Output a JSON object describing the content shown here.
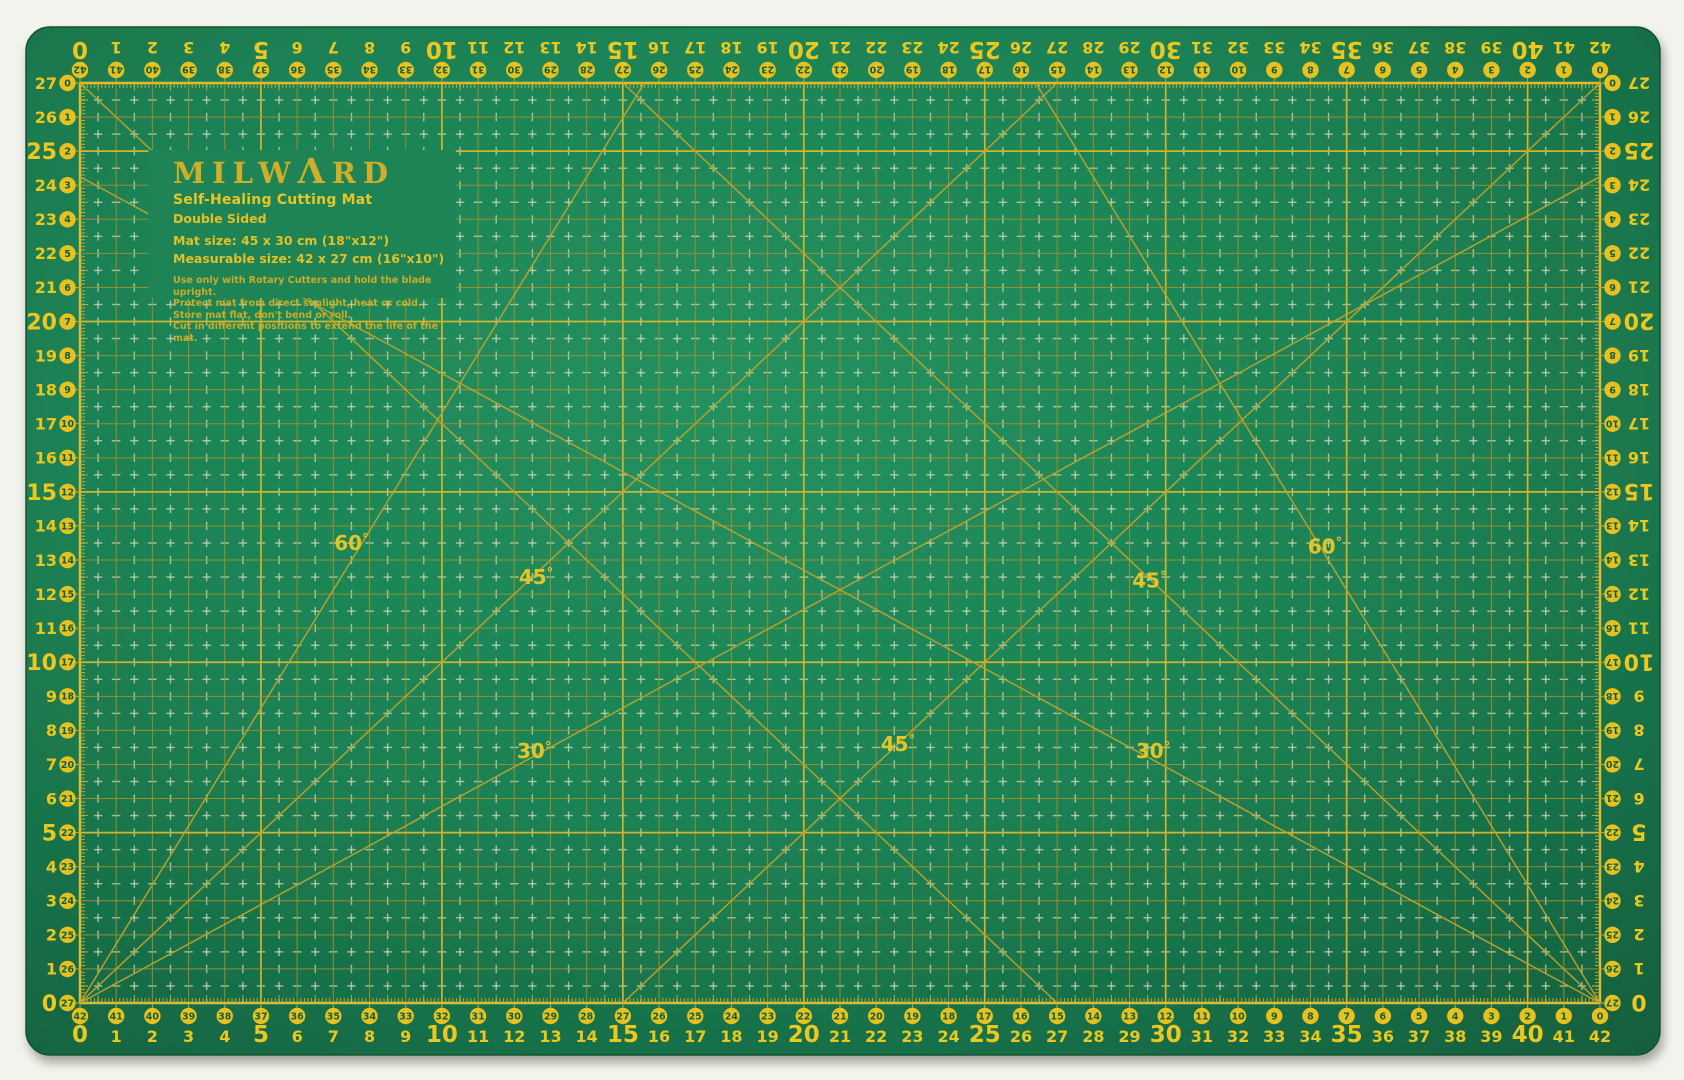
{
  "photo": {
    "backdrop_color": "#f3f3ee"
  },
  "mat": {
    "base_color": "#1d8154",
    "vignette_inner": "#229160",
    "vignette_outer": "#135e3d",
    "minor_line_color": "#a3902f",
    "major_line_color": "#d2b430",
    "boundary_line_color": "#ddbe36",
    "tick_color": "#cbad2e",
    "diagonal_color": "#bda32d",
    "cross_color": "#d6dbb0",
    "number_color": "#ecc71f",
    "circle_fill": "#e7c120",
    "circle_text_color": "#14603e",
    "angle_label_color": "#e6c427",
    "measurable_cm": {
      "width": 42,
      "height": 27
    }
  },
  "label_block": {
    "brand": "MILWARD",
    "brand_display": "MILWΛRD",
    "title": "Self-Healing Cutting Mat",
    "subtitle": "Double Sided",
    "mat_size": "Mat size: 45 x 30 cm (18\"x12\")",
    "measurable_size": "Measurable size: 42 x 27 cm (16\"x10\")",
    "notes": [
      "Use only with Rotary Cutters and hold the blade upright.",
      "Protect mat from direct sunlight, heat or cold.",
      "Store mat flat, don't bend or roll.",
      "Cut in different positions to extend the life of the mat."
    ]
  },
  "rulers": {
    "horizontal": {
      "numbers": [
        0,
        1,
        2,
        3,
        4,
        5,
        6,
        7,
        8,
        9,
        10,
        11,
        12,
        13,
        14,
        15,
        16,
        17,
        18,
        19,
        20,
        21,
        22,
        23,
        24,
        25,
        26,
        27,
        28,
        29,
        30,
        31,
        32,
        33,
        34,
        35,
        36,
        37,
        38,
        39,
        40,
        41,
        42
      ],
      "circles": [
        42,
        41,
        40,
        39,
        38,
        37,
        36,
        35,
        34,
        33,
        32,
        31,
        30,
        29,
        28,
        27,
        26,
        25,
        24,
        23,
        22,
        21,
        20,
        19,
        18,
        17,
        16,
        15,
        14,
        13,
        12,
        11,
        10,
        9,
        8,
        7,
        6,
        5,
        4,
        3,
        2,
        1,
        0
      ]
    },
    "vertical": {
      "numbers": [
        27,
        26,
        25,
        24,
        23,
        22,
        21,
        20,
        19,
        18,
        17,
        16,
        15,
        14,
        13,
        12,
        11,
        10,
        9,
        8,
        7,
        6,
        5,
        4,
        3,
        2,
        1,
        0
      ],
      "circles": [
        0,
        1,
        2,
        3,
        4,
        5,
        6,
        7,
        8,
        9,
        10,
        11,
        12,
        13,
        14,
        15,
        16,
        17,
        18,
        19,
        20,
        21,
        22,
        23,
        24,
        25,
        26,
        27
      ]
    }
  },
  "angle_labels": [
    {
      "text": "60°",
      "x": 7.5,
      "y": 13.5
    },
    {
      "text": "45°",
      "x": 12.6,
      "y": 12.5
    },
    {
      "text": "30°",
      "x": 12.55,
      "y": 7.4
    },
    {
      "text": "45°",
      "x": 22.6,
      "y": 7.6
    },
    {
      "text": "45°",
      "x": 29.55,
      "y": 12.4
    },
    {
      "text": "60°",
      "x": 34.4,
      "y": 13.4
    },
    {
      "text": "30°",
      "x": 29.65,
      "y": 7.4
    }
  ],
  "diagonals": [
    {
      "angle": 60,
      "x1": 0,
      "y1": 0,
      "x2": 15.59,
      "y2": 27
    },
    {
      "angle": 45,
      "x1": 0,
      "y1": 0,
      "x2": 27,
      "y2": 27
    },
    {
      "angle": 30,
      "x1": 0,
      "y1": 0,
      "x2": 42,
      "y2": 24.25
    },
    {
      "angle": 60,
      "x1": 42,
      "y1": 0,
      "x2": 26.41,
      "y2": 27
    },
    {
      "angle": 45,
      "x1": 42,
      "y1": 0,
      "x2": 15,
      "y2": 27
    },
    {
      "angle": 30,
      "x1": 42,
      "y1": 0,
      "x2": 0,
      "y2": 24.25
    },
    {
      "angle": 45,
      "x1": 15,
      "y1": 0,
      "x2": 42,
      "y2": 27
    },
    {
      "angle": 45,
      "x1": 27,
      "y1": 0,
      "x2": 0,
      "y2": 27
    }
  ]
}
